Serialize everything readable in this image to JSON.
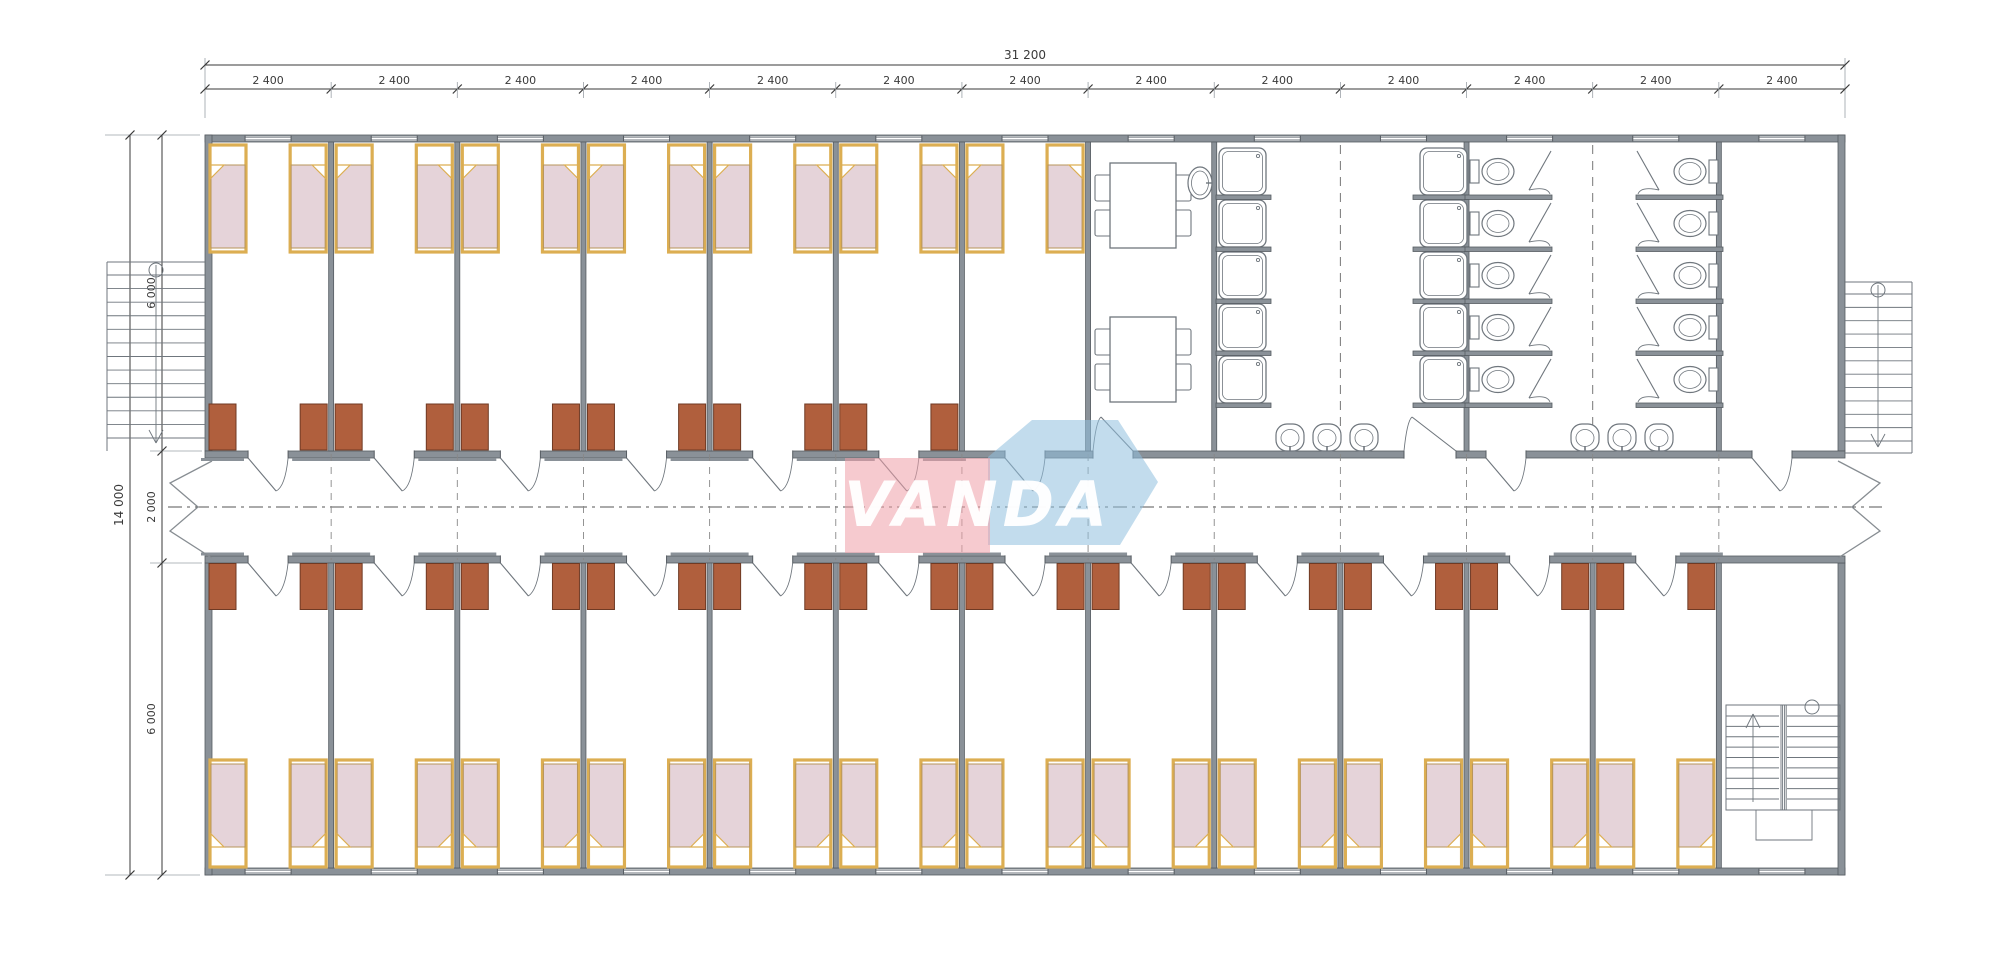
{
  "drawing": {
    "type": "floor-plan",
    "building": "modular dormitory block",
    "modules": 13,
    "module_width_label": "2 400",
    "top_bedrooms": 7,
    "bottom_bedrooms": 12,
    "beds_per_room": 2,
    "wardrobes_per_room": 2,
    "shower_stalls": 10,
    "toilet_stalls": 10,
    "wash_basins": 6,
    "dining_tables": 2,
    "chairs_per_table": 4,
    "stairs": [
      "external-left-stair",
      "external-right-stair",
      "internal-right-stair"
    ]
  },
  "dimensions": {
    "top_total": "31 200",
    "top_segments": [
      "2 400",
      "2 400",
      "2 400",
      "2 400",
      "2 400",
      "2 400",
      "2 400",
      "2 400",
      "2 400",
      "2 400",
      "2 400",
      "2 400",
      "2 400"
    ],
    "left_total": "14 000",
    "left_segments": [
      "6 000",
      "2 000",
      "6 000"
    ]
  },
  "watermark": {
    "text": "VANDA",
    "pink": "#ef9fa8",
    "blue": "#8fc0de",
    "text_color": "#ffffff"
  },
  "colors": {
    "wall": "#8a9198",
    "wall_edge": "#565c62",
    "bed_frame": "#dcae52",
    "bed_blanket": "#e5d3d9",
    "blanket_edge": "#b8955a",
    "wardrobe": "#b05f3d",
    "wardrobe_edge": "#6f3a24",
    "fixture": "#6f767d",
    "dim": "#3a3a3a",
    "thin": "#9aa0a6"
  }
}
